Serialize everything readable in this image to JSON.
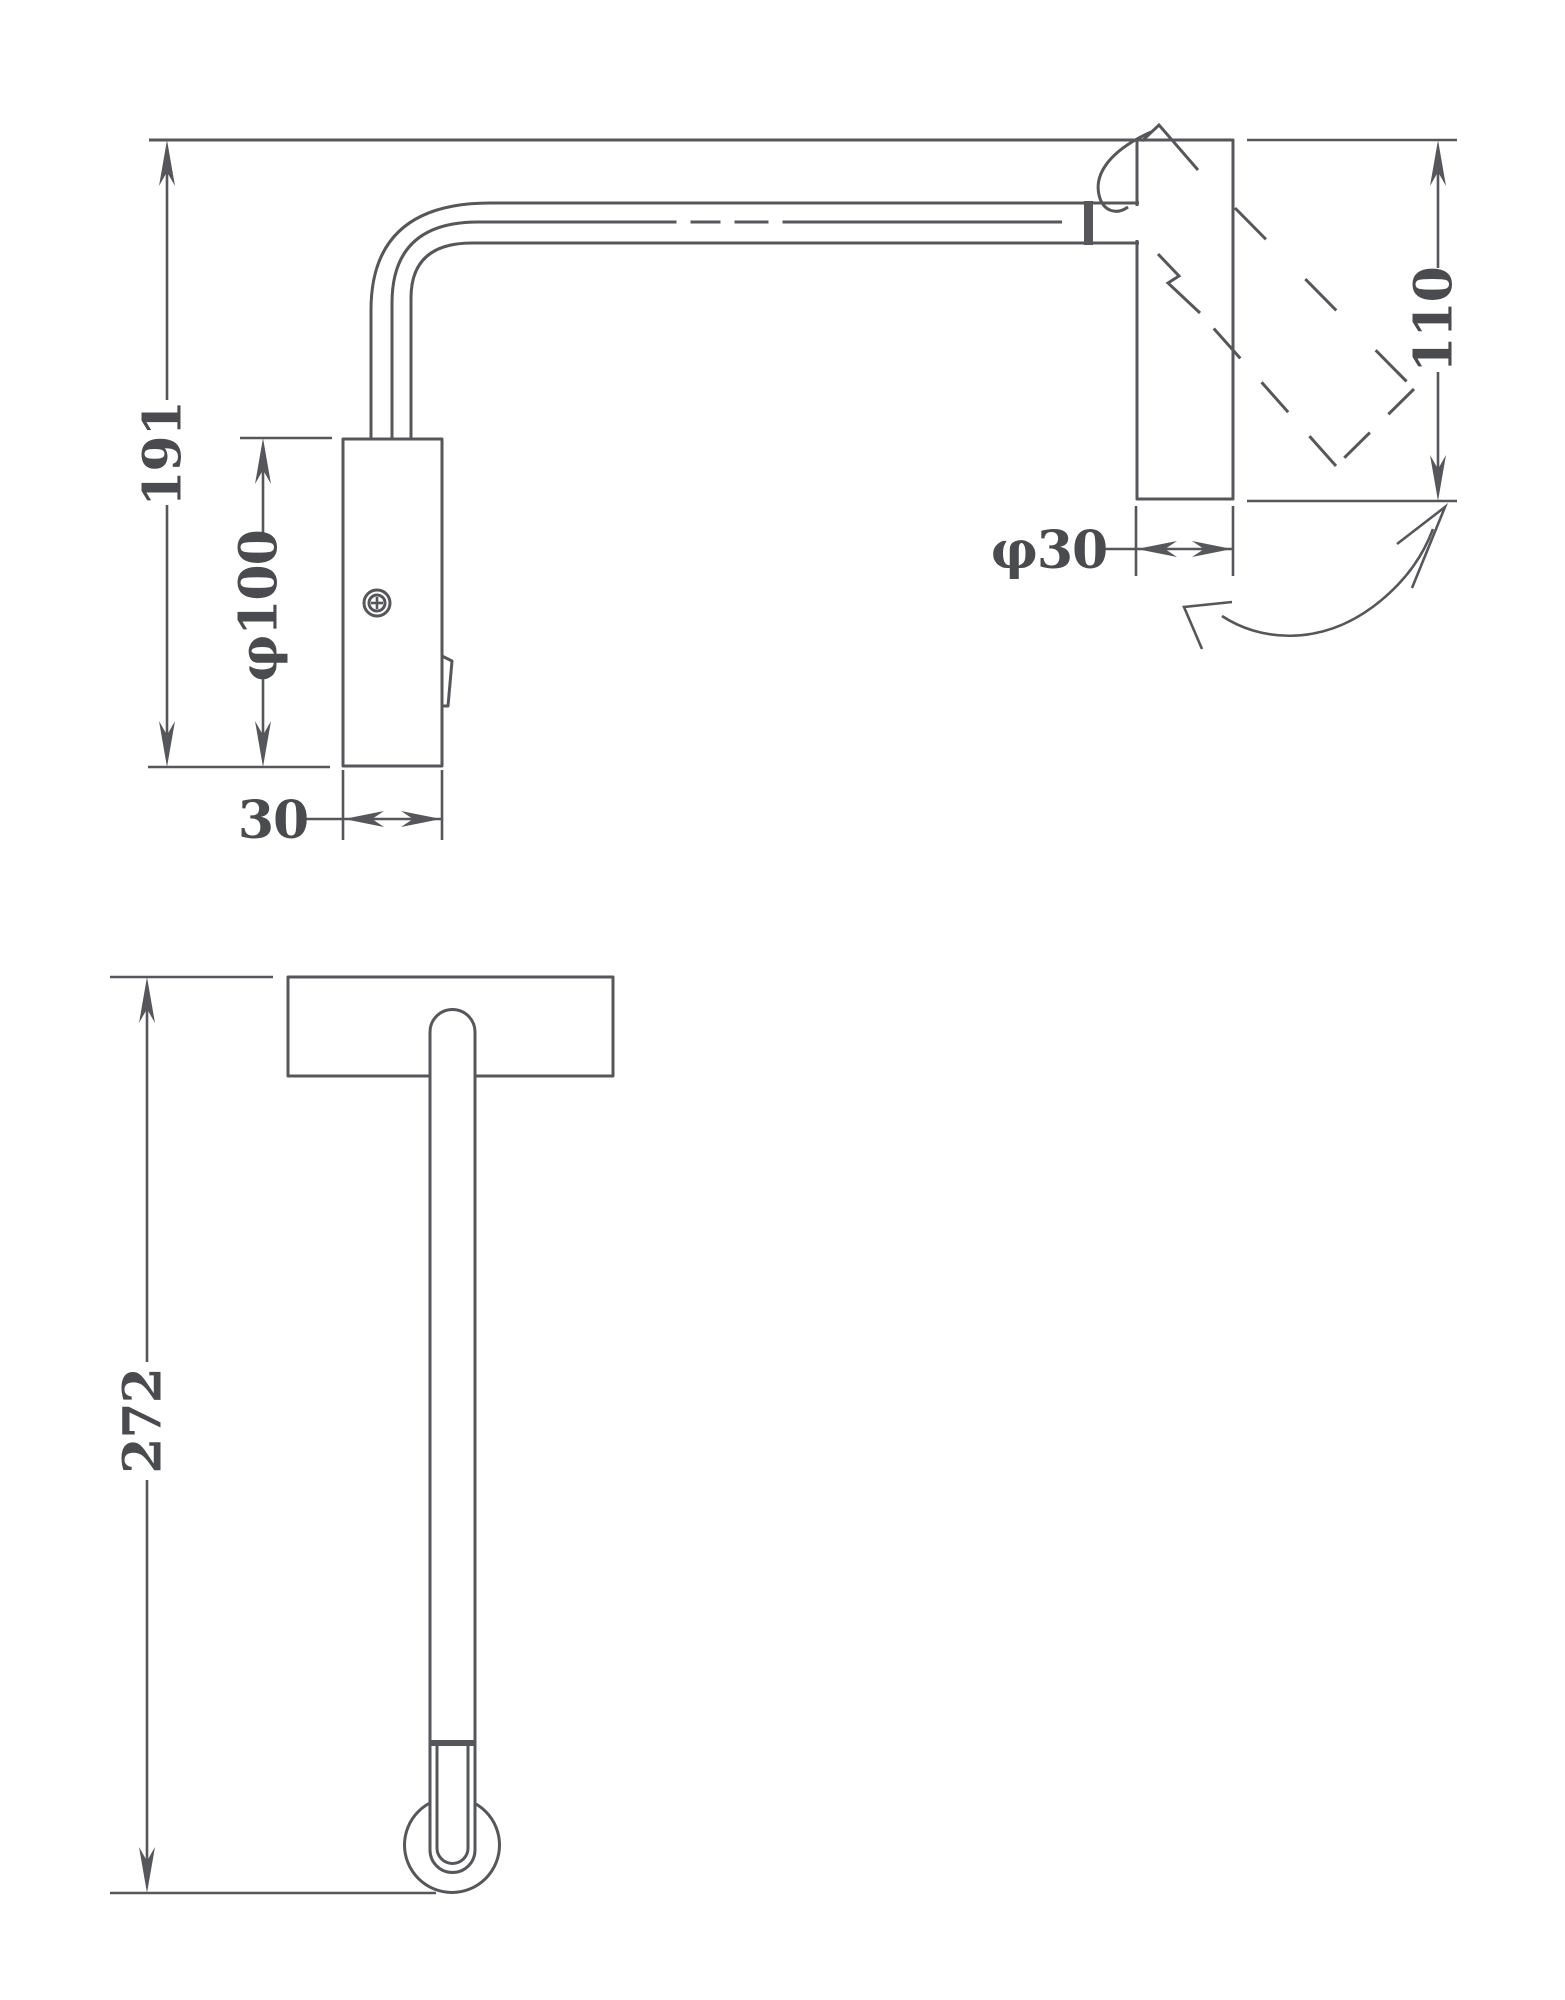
{
  "drawing": {
    "type": "technical-dimension-drawing",
    "subject": "wall-mounted swivel reading lamp",
    "background_color": "#ffffff",
    "line_color": "#56575b",
    "text_color": "#4a4b4e",
    "side_view": {
      "dims": {
        "overall_height": "191",
        "backplate_length": "φ100",
        "backplate_width": "30",
        "head_length": "110",
        "head_diameter": "φ30"
      }
    },
    "front_view": {
      "dims": {
        "overall_projection": "272"
      }
    }
  }
}
